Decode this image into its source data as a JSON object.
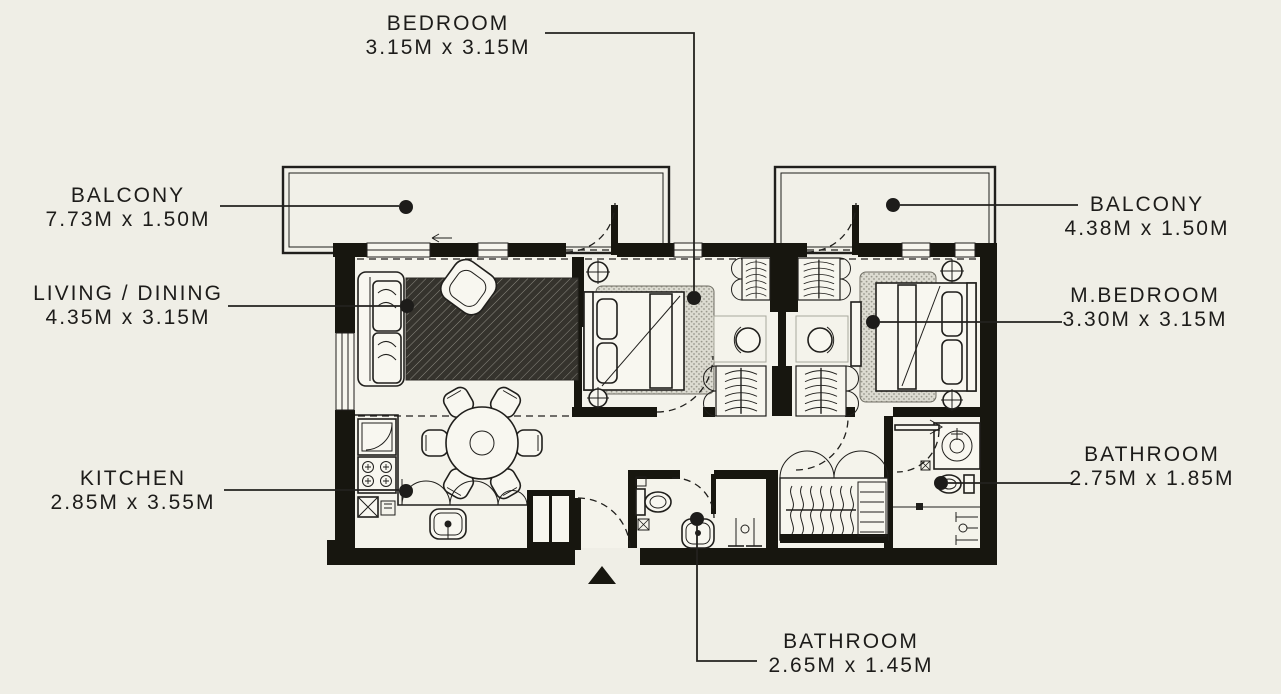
{
  "canvas": {
    "width": 1281,
    "height": 694,
    "background": "#efeee6",
    "ink": "#1d1c1a"
  },
  "plan_type": "apartment-floor-plan",
  "labels": [
    {
      "id": "bedroom",
      "room": "BEDROOM",
      "size": "3.15M x 3.15M",
      "position": "top"
    },
    {
      "id": "balcony-left",
      "room": "BALCONY",
      "size": "7.73M x 1.50M",
      "position": "left"
    },
    {
      "id": "living-dining",
      "room": "LIVING / DINING",
      "size": "4.35M x 3.15M",
      "position": "left"
    },
    {
      "id": "kitchen",
      "room": "KITCHEN",
      "size": "2.85M x 3.55M",
      "position": "left"
    },
    {
      "id": "balcony-right",
      "room": "BALCONY",
      "size": "4.38M x 1.50M",
      "position": "right"
    },
    {
      "id": "m-bedroom",
      "room": "M.BEDROOM",
      "size": "3.30M x 3.15M",
      "position": "right"
    },
    {
      "id": "bathroom-right",
      "room": "BATHROOM",
      "size": "2.75M x 1.85M",
      "position": "right"
    },
    {
      "id": "bathroom-bottom",
      "room": "BATHROOM",
      "size": "2.65M x 1.45M",
      "position": "bottom"
    }
  ]
}
